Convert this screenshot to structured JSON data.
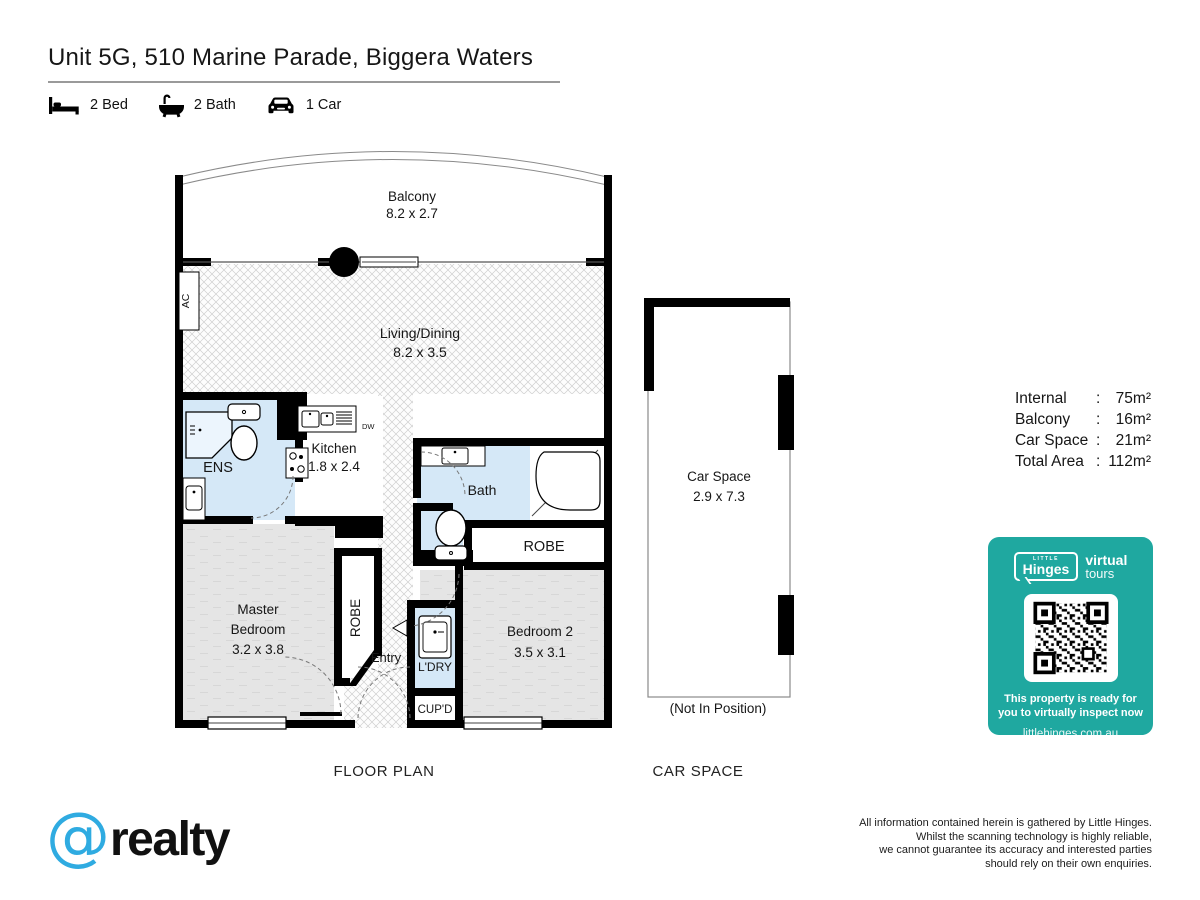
{
  "header": {
    "title": "Unit 5G, 510 Marine Parade, Biggera Waters",
    "features": [
      {
        "icon": "bed-icon",
        "label": "2 Bed"
      },
      {
        "icon": "bath-icon",
        "label": "2 Bath"
      },
      {
        "icon": "car-icon",
        "label": "1 Car"
      }
    ]
  },
  "plan": {
    "section_label": "FLOOR PLAN",
    "balcony": {
      "name": "Balcony",
      "dims": "8.2 x 2.7"
    },
    "living": {
      "name": "Living/Dining",
      "dims": "8.2 x 3.5"
    },
    "kitchen": {
      "name": "Kitchen",
      "dims": "1.8 x 2.4"
    },
    "master": {
      "line1": "Master",
      "line2": "Bedroom",
      "dims": "3.2 x 3.8"
    },
    "bedroom2": {
      "name": "Bedroom 2",
      "dims": "3.5 x 3.1"
    },
    "ens": "ENS",
    "bath": "Bath",
    "robe_master": "ROBE",
    "robe_bed2": "ROBE",
    "entry": "Entry",
    "laundry": "L'DRY",
    "cupboard": "CUP'D",
    "ac": "AC",
    "dw": "DW"
  },
  "car_space": {
    "section_label": "CAR SPACE",
    "name": "Car Space",
    "dims": "2.9 x 7.3",
    "note": "(Not In Position)"
  },
  "areas": {
    "rows": [
      {
        "label": "Internal",
        "sep": ":",
        "value": "75m²"
      },
      {
        "label": "Balcony",
        "sep": ":",
        "value": "16m²"
      },
      {
        "label": "Car Space",
        "sep": ":",
        "value": "21m²"
      },
      {
        "label": "Total Area",
        "sep": ":",
        "value": "112m²"
      }
    ]
  },
  "badge": {
    "brand_top": "LITTLE",
    "brand": "Hinges",
    "product_line1": "virtual",
    "product_line2": "tours",
    "message_line1": "This property is ready for",
    "message_line2": "you to virtually inspect now",
    "url": "littlehinges.com.au"
  },
  "footer": {
    "logo_symbol": "@",
    "logo_name": "realty",
    "disclaimer": [
      "All information contained herein is gathered by Little Hinges.",
      "Whilst the scanning technology is highly reliable,",
      "we cannot guarantee its accuracy and interested parties",
      "should rely on their own enquiries."
    ]
  },
  "colors": {
    "teal": "#1FA8A0",
    "logo_blue": "#2FABE1",
    "wet_area": "#D5E8F7"
  }
}
